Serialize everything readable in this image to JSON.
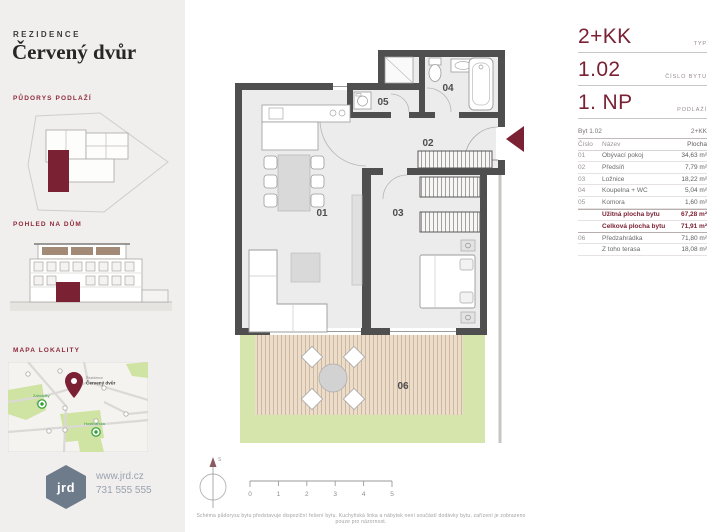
{
  "colors": {
    "accent": "#7b2134",
    "wall": "#4f4f4f",
    "terrace_green": "#d6e5ac"
  },
  "brand": {
    "prefix": "REZIDENCE",
    "name": "Červený dvůr"
  },
  "sidebar": {
    "sections": [
      {
        "label": "PŮDORYS PODLAŽÍ"
      },
      {
        "label": "POHLED NA DŮM"
      },
      {
        "label": "MAPA LOKALITY"
      }
    ],
    "map": {
      "pin_line1": "Rezidence",
      "pin_line2": "Červený dvůr",
      "poi1": "Zahrádky",
      "poi2": "Hostivařská"
    },
    "logo": {
      "text": "jrd",
      "website": "www.jrd.cz",
      "phone": "731 555 555"
    }
  },
  "unit": {
    "type": {
      "value": "2+KK",
      "label": "TYP"
    },
    "number": {
      "value": "1.02",
      "label": "ČÍSLO BYTU"
    },
    "floor": {
      "value": "1. NP",
      "label": "PODLAŽÍ"
    }
  },
  "table": {
    "header_left": "Byt 1.02",
    "header_right": "2+KK",
    "columns": {
      "num": "Číslo",
      "name": "Název",
      "area": "Plocha"
    },
    "rows": [
      {
        "num": "01",
        "name": "Obývací pokoj",
        "area": "34,63 m²"
      },
      {
        "num": "02",
        "name": "Předsíň",
        "area": "7,79 m²"
      },
      {
        "num": "03",
        "name": "Ložnice",
        "area": "18,22 m²"
      },
      {
        "num": "04",
        "name": "Koupelna + WC",
        "area": "5,04 m²"
      },
      {
        "num": "05",
        "name": "Komora",
        "area": "1,60 m²"
      }
    ],
    "summary": [
      {
        "name": "Užitná plocha bytu",
        "area": "67,28 m²"
      },
      {
        "name": "Celková plocha bytu",
        "area": "71,91 m²"
      }
    ],
    "extra": [
      {
        "num": "06",
        "name": "Předzahrádka",
        "area": "71,80 m²"
      },
      {
        "num": "",
        "name": "Z toho terasa",
        "area": "18,08 m²"
      }
    ]
  },
  "plan": {
    "rooms": [
      {
        "id": "01"
      },
      {
        "id": "02"
      },
      {
        "id": "03"
      },
      {
        "id": "04"
      },
      {
        "id": "05"
      },
      {
        "id": "06"
      }
    ],
    "compass_label": "S",
    "scale_ticks": [
      "0",
      "1",
      "2",
      "3",
      "4",
      "5"
    ],
    "disclaimer": "Schéma půdorysu bytu představuje dispoziční řešení bytu. Kuchyňská linka a nábytek není součástí dodávky bytu, zařízení je zobrazeno pouze pro názornost."
  }
}
